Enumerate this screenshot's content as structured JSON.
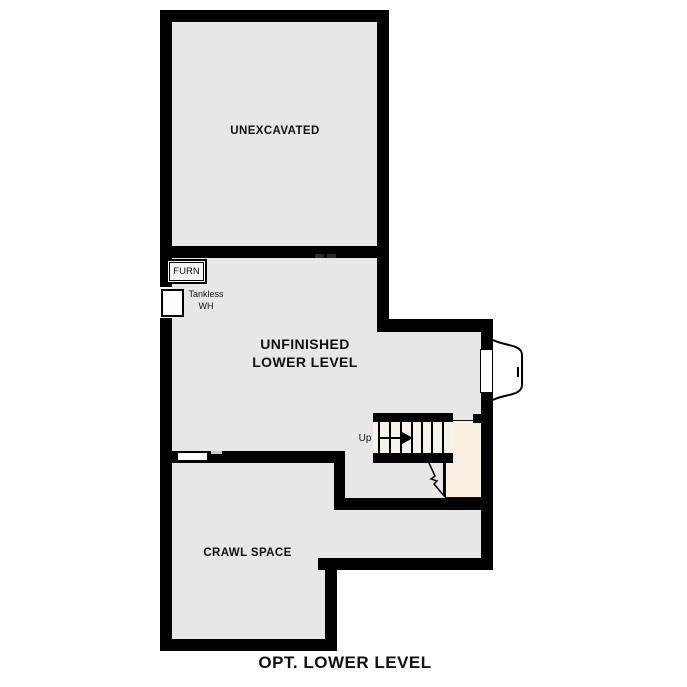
{
  "title": "OPT. LOWER LEVEL",
  "rooms": {
    "unexcavated": "UNEXCAVATED",
    "lower_level_line1": "UNFINISHED",
    "lower_level_line2": "LOWER LEVEL",
    "crawl_space": "CRAWL SPACE"
  },
  "fixtures": {
    "furnace": "FURN",
    "water_heater_line1": "Tankless",
    "water_heater_line2": "WH"
  },
  "stairs": {
    "direction_label": "Up"
  },
  "colors": {
    "wall": "#000000",
    "floor": "#e8e7e5",
    "stair": "#f7f3ea",
    "landing": "#f8f1e1",
    "text": "#111111"
  }
}
